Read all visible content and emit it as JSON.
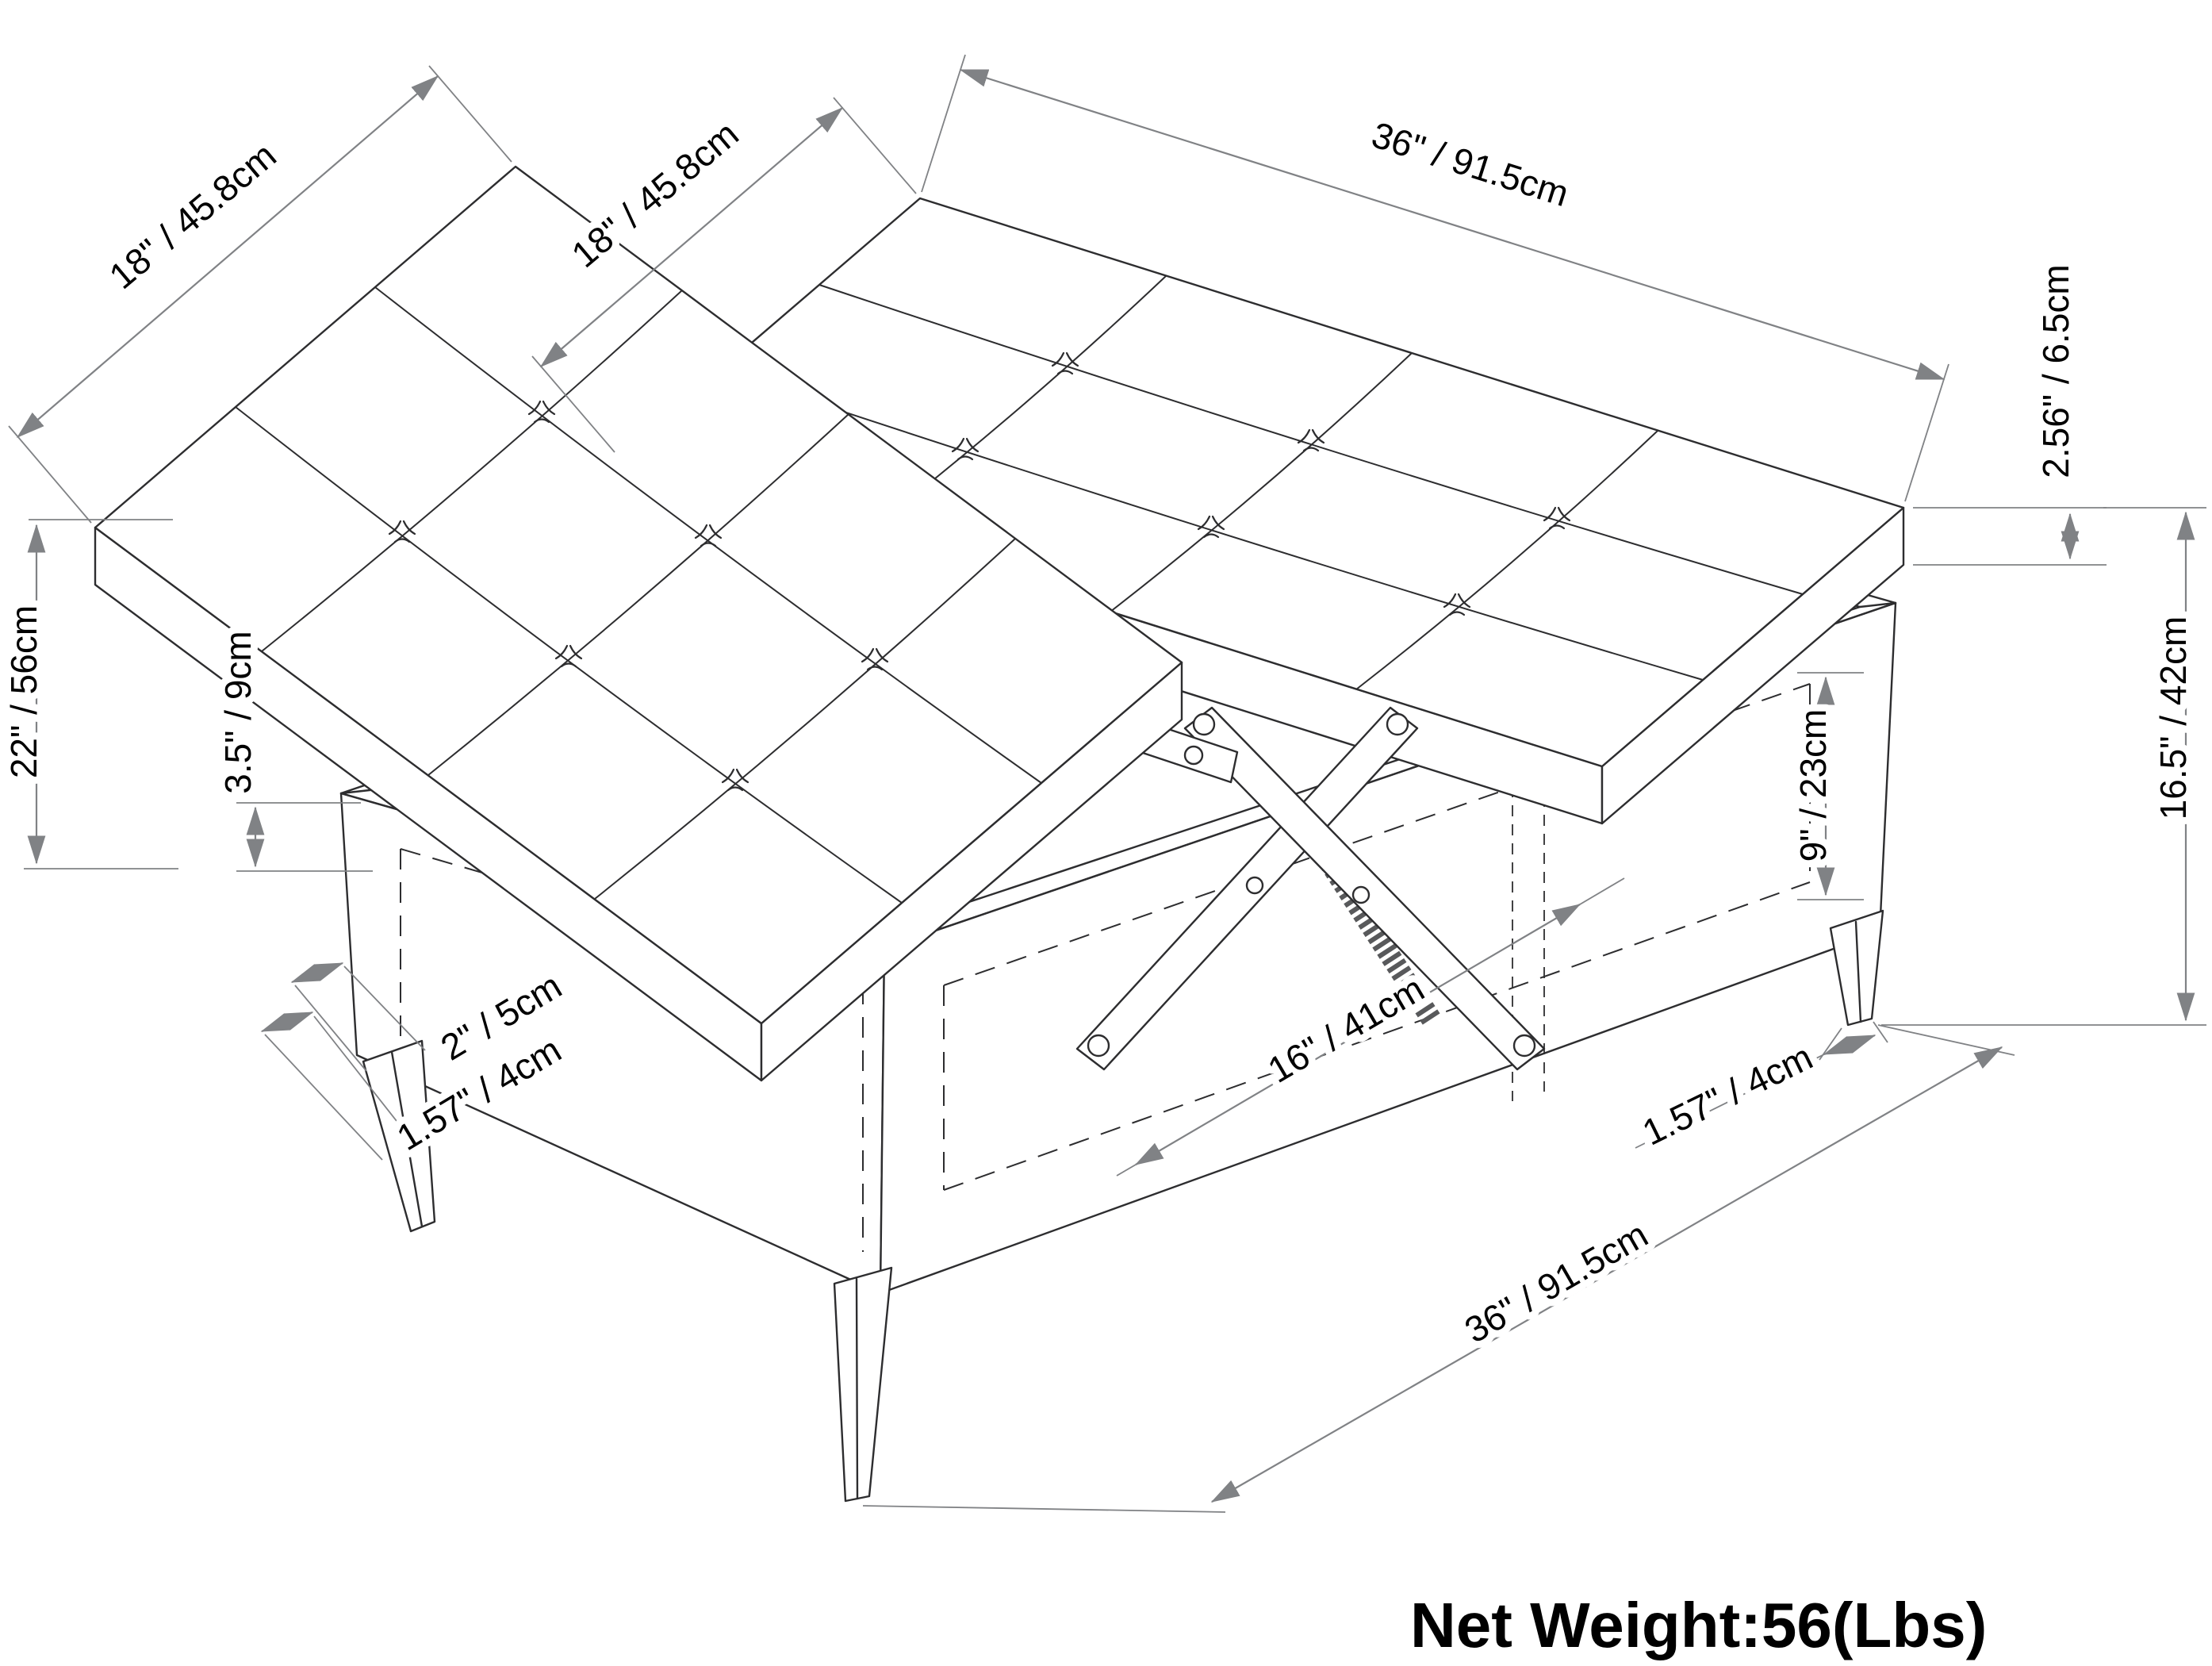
{
  "diagram": {
    "type": "isometric-technical-drawing",
    "subject": "square storage ottoman with two tufted lift-top lids, scissor lift mechanism and tapered legs",
    "colors": {
      "background": "#ffffff",
      "object_line": "#2d2d2f",
      "dimension_line": "#808285",
      "label_text": "#000000"
    },
    "dimensions": {
      "lid_left_depth": "18\" / 45.8cm",
      "lid_right_depth": "18\" / 45.8cm",
      "lid_length": "36\" / 91.5cm",
      "lid_thickness": "2.56\" / 6.5cm",
      "open_height_left": "22\" / 56cm",
      "leg_clearance": "3.5\" / 9cm",
      "storage_depth": "9\" / 23cm",
      "base_height": "16.5\" / 42cm",
      "leg_top_width": "2\" / 5cm",
      "leg_bottom_width_left": "1.57\" / 4cm",
      "storage_opening_width": "16\" / 41cm",
      "leg_bottom_width_right": "1.57\" / 4cm",
      "base_length": "36\" / 91.5cm"
    },
    "footer": {
      "net_weight": "Net Weight:56(Lbs)"
    }
  }
}
